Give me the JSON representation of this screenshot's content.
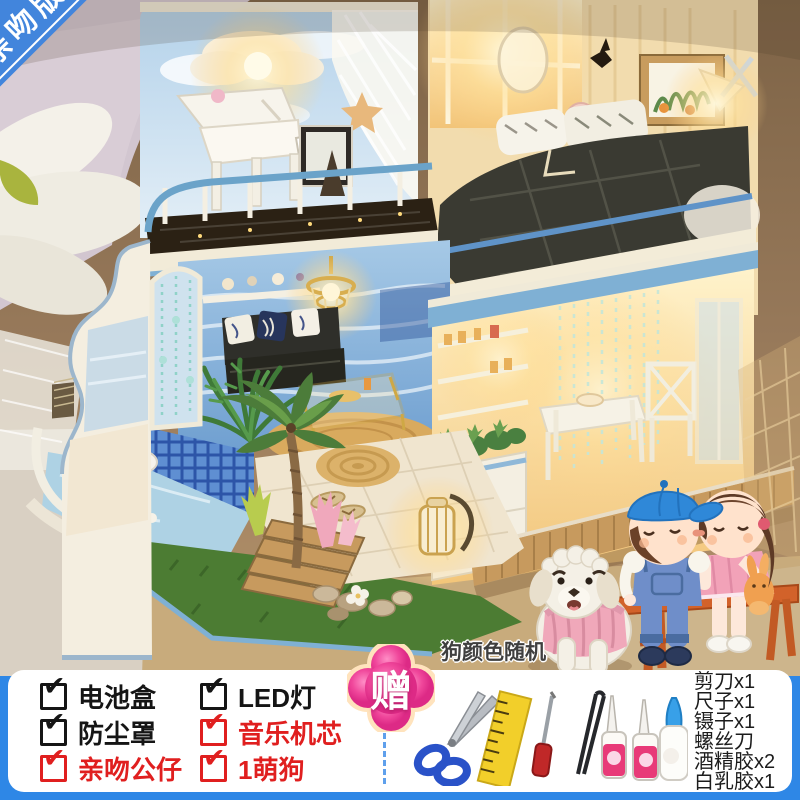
{
  "ribbon": {
    "label": "亲吻版"
  },
  "photo": {
    "dog_note": "狗颜色随机"
  },
  "gift_badge": {
    "label": "赠"
  },
  "checklist": {
    "check_glyph": "✔",
    "items": [
      {
        "label": "电池盒",
        "style": "black"
      },
      {
        "label": "LED灯",
        "style": "black"
      },
      {
        "label": "防尘罩",
        "style": "black"
      },
      {
        "label": "音乐机芯",
        "style": "red"
      },
      {
        "label": "亲吻公仔",
        "style": "red"
      },
      {
        "label": "1萌狗",
        "style": "red"
      }
    ]
  },
  "tools": {
    "items": [
      "剪刀x1",
      "尺子x1",
      "镊子x1",
      "螺丝刀",
      "酒精胶x2",
      "白乳胶x1"
    ]
  },
  "colors": {
    "banner_blue": "#2E87E6",
    "ribbon_blue": "#4285DC",
    "red": "#E01F1F",
    "badge_pink": "#EF3F96"
  }
}
